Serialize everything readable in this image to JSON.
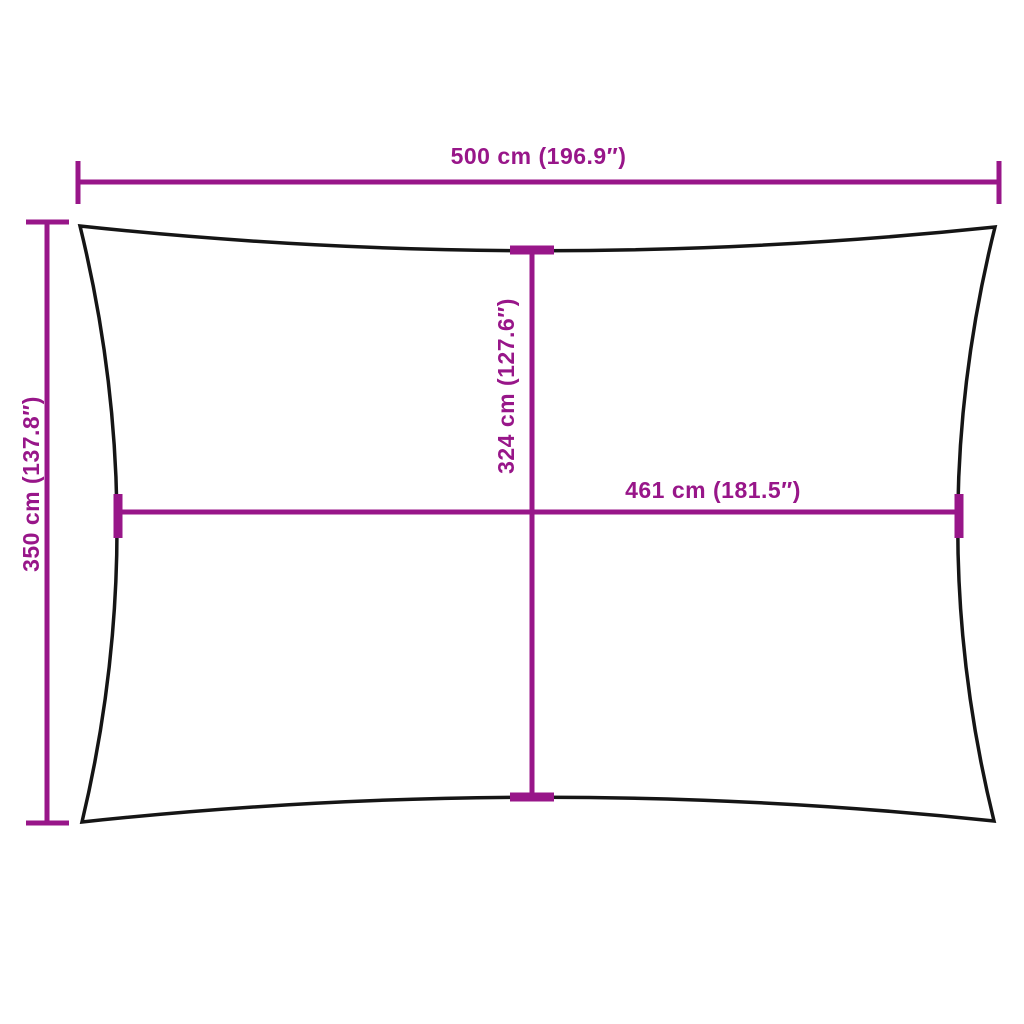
{
  "diagram": {
    "title": "shade-sail-dimension-diagram",
    "shape": "rectangle-concave-edges",
    "colors": {
      "accent": "#981689",
      "outline": "#151515",
      "background": "#ffffff"
    },
    "dimensions": {
      "overall_width": {
        "label": "500 cm (196.9″)",
        "cm": 500,
        "inches": 196.9,
        "position": "top"
      },
      "overall_height": {
        "label": "350 cm (137.8″)",
        "cm": 350,
        "inches": 137.8,
        "position": "left"
      },
      "inner_height": {
        "label": "324 cm (127.6″)",
        "cm": 324,
        "inches": 127.6,
        "position": "center-vertical"
      },
      "inner_width": {
        "label": "461 cm (181.5″)",
        "cm": 461,
        "inches": 181.5,
        "position": "center-horizontal"
      }
    }
  }
}
